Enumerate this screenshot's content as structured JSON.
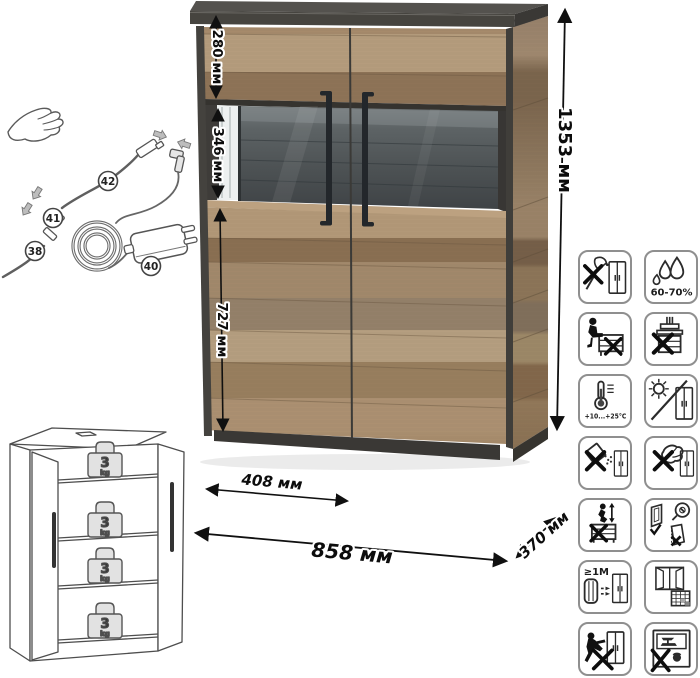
{
  "title": "Furniture dimensions diagram",
  "cabinet": {
    "dimensions": {
      "top_section_height": "280 мм",
      "vitrine_height": "346 мм",
      "lower_section_height": "727 мм",
      "door_width": "408 мм",
      "width": "858 мм",
      "depth": "370 мм",
      "height": "1353 мм"
    },
    "colors": {
      "wood_light": "#b79e7e",
      "wood_mid": "#a38a6c",
      "wood_dark": "#8b7053",
      "frame_dark": "#45423f",
      "glass_back": "#53585a",
      "handle": "#272b2f"
    }
  },
  "cable_diagram": {
    "callouts": {
      "c38": "38",
      "c40": "40",
      "c41": "41",
      "c42": "42"
    }
  },
  "schematic": {
    "shelf_load_value": "3",
    "shelf_load_unit": "kg"
  },
  "care_icons": {
    "humidity_label": "60-70%",
    "temperature_label": "+10...+25°C",
    "distance_label": "≥1M",
    "items": [
      "no-chopping",
      "humidity-60-70",
      "no-sitting",
      "no-pressing",
      "temperature-range",
      "no-direct-sunlight",
      "no-spilling-liquids",
      "no-abrasive-cleaning",
      "no-climbing",
      "adjust-doors",
      "keep-1m-from-heaters",
      "ventilate-room",
      "no-pushing",
      "no-heavy-loads"
    ]
  }
}
